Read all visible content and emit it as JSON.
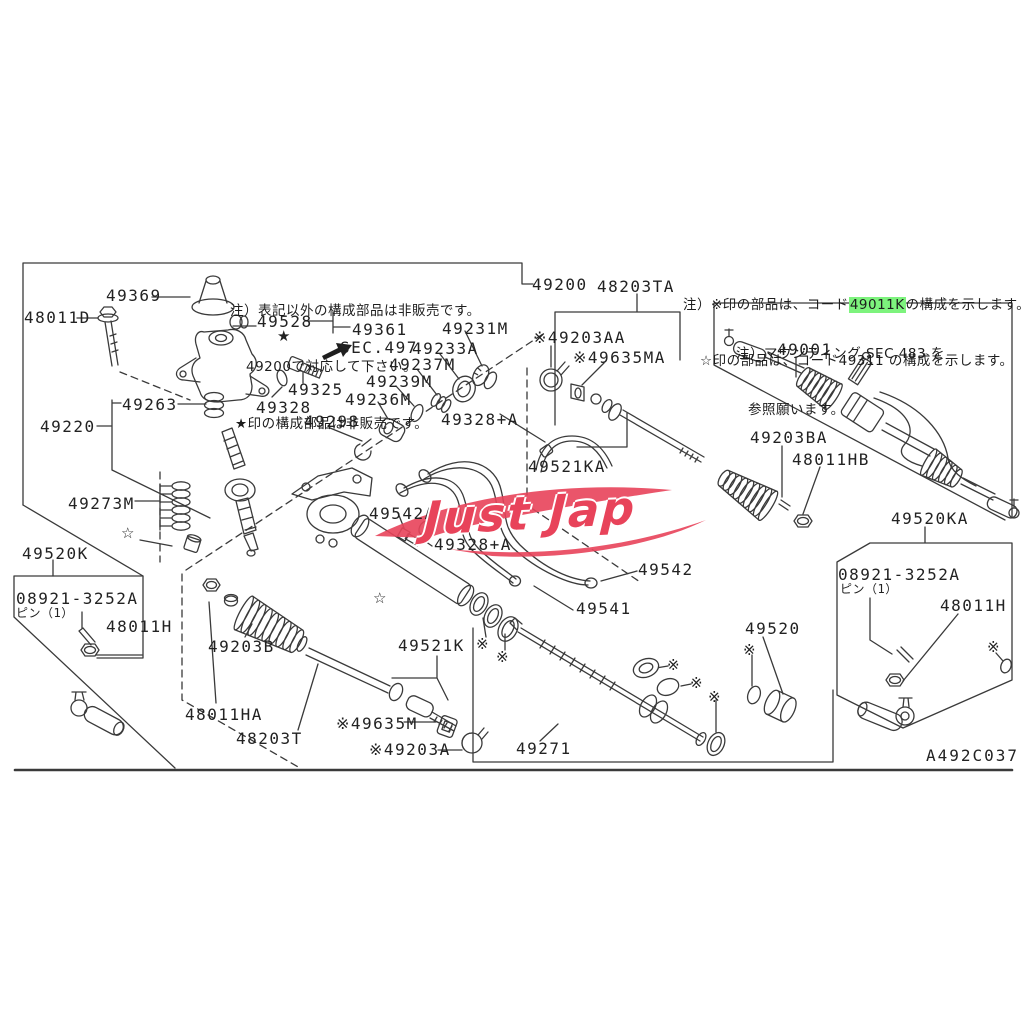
{
  "colors": {
    "highlight": "#7DF37D",
    "watermark": "#E8435A",
    "line": "#3A3A3A",
    "background": "#FFFFFF"
  },
  "watermark": {
    "text": "Just Jap"
  },
  "notes": {
    "sale1": "注）表記以外の構成部品は非販売です。",
    "sale2": "49200で対応して下さい。",
    "sale3": "★印の構成部品は非販売です。",
    "ref_prefix": "注）※印の部品は、コード",
    "ref_code": "49011K",
    "ref_suffix": "の構成を示します。",
    "ref_line2": "☆印の部品は、コード49311 の構成を示します。",
    "mount1": "注）マウンティング SEC.483 を",
    "mount2": "参照願います。"
  },
  "marks": {
    "star_filled": "★",
    "star_open": "☆",
    "component_ref": "※"
  },
  "parts": {
    "p49369": "49369",
    "p48011D": "48011D",
    "p49528": "49528",
    "p49361": "49361",
    "sec497": "SEC.497",
    "p49231M": "49231M",
    "p49233A": "49233A",
    "p49237M": "49237M",
    "p49239M": "49239M",
    "p49236M": "49236M",
    "p49325": "49325",
    "p49328": "49328",
    "p49298": "49298",
    "p49263": "49263",
    "p49220": "49220",
    "p49273M": "49273M",
    "p49520K": "49520K",
    "p08921": "08921-3252A",
    "pin1": "ピン（1）",
    "p48011H": "48011H",
    "p49203B": "49203B",
    "p48011HA": "48011HA",
    "p48203T": "48203T",
    "p49635M": "※49635M",
    "p49203A": "※49203A",
    "p49521K": "49521K",
    "p49542A": "49542A",
    "p49328A": "49328+A",
    "p49542": "49542",
    "p49541": "49541",
    "p49271": "49271",
    "p49200": "49200",
    "p48203TA": "48203TA",
    "p49203AA": "※49203AA",
    "p49635MA": "※49635MA",
    "p49521KA": "49521KA",
    "p49203BA": "49203BA",
    "p48011HB": "48011HB",
    "p49001": "49001",
    "p49520KA": "49520KA",
    "p08921b": "08921-3252A",
    "pin1b": "ピン（1）",
    "p48011Hb": "48011H",
    "p49520": "49520",
    "diagram_code": "A492C037"
  }
}
